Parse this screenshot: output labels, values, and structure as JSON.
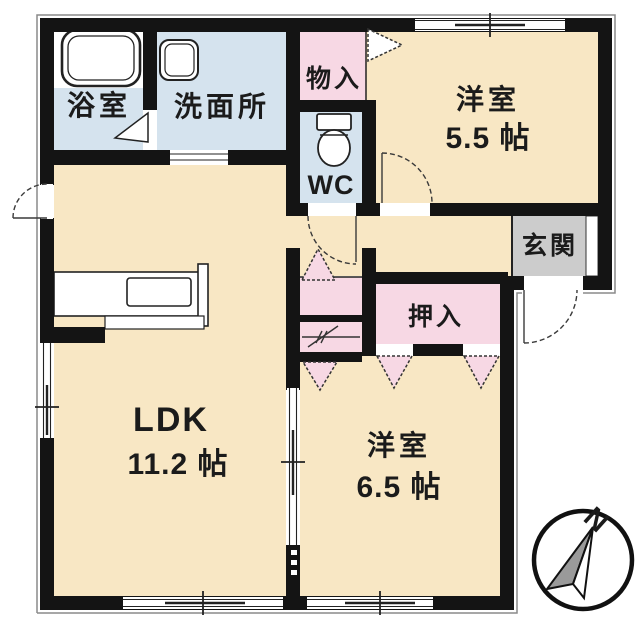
{
  "title": "apartment-floor-plan",
  "rooms": {
    "bathroom": {
      "label": "浴室"
    },
    "washroom": {
      "label": "洗面所"
    },
    "storage": {
      "label": "物入"
    },
    "toilet": {
      "label": "WC"
    },
    "bedroom1": {
      "label": "洋室",
      "size": "5.5 帖"
    },
    "entrance": {
      "label": "玄関"
    },
    "closet": {
      "label": "押入"
    },
    "ldk": {
      "label": "LDK",
      "size": "11.2 帖"
    },
    "bedroom2": {
      "label": "洋室",
      "size": "6.5 帖"
    }
  },
  "compass": {
    "north_label": "N"
  },
  "icons": {
    "bathtub": "bathtub-icon",
    "washbasin": "washbasin-icon",
    "toilet": "toilet-icon",
    "kitchen_counter": "kitchen-counter-icon",
    "compass": "compass-north-icon"
  },
  "colors": {
    "cream": "#f8e7c4",
    "blue": "#d5e3ee",
    "pink": "#f7d8e4",
    "gray": "#cccccc",
    "wall": "#141414",
    "line": "#333333",
    "compass_gray": "#9a9a9a"
  }
}
